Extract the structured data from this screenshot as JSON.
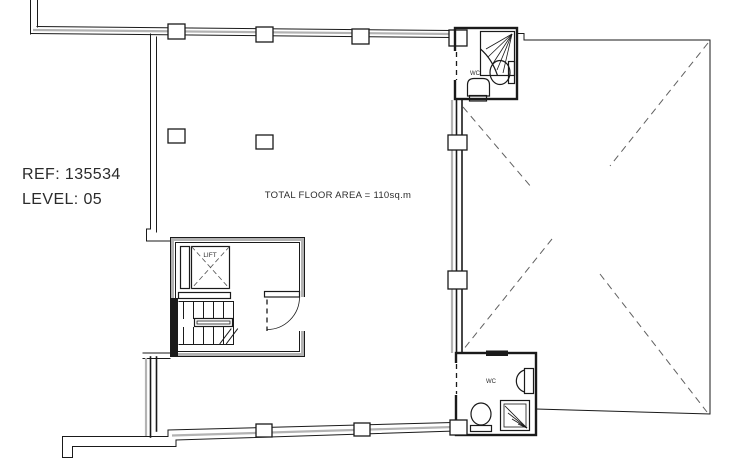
{
  "labels": {
    "ref": "REF: 135534",
    "level": "LEVEL: 05",
    "floor_area": "TOTAL FLOOR AREA = 110sq.m",
    "lift": "LIFT",
    "wc_top": "WC",
    "wc_bottom": "WC"
  },
  "colors": {
    "background": "#ffffff",
    "wall": "#1a1a1a",
    "wall_secondary": "#b3b3b3",
    "dashed": "#606060",
    "text": "#2b2b2b"
  }
}
